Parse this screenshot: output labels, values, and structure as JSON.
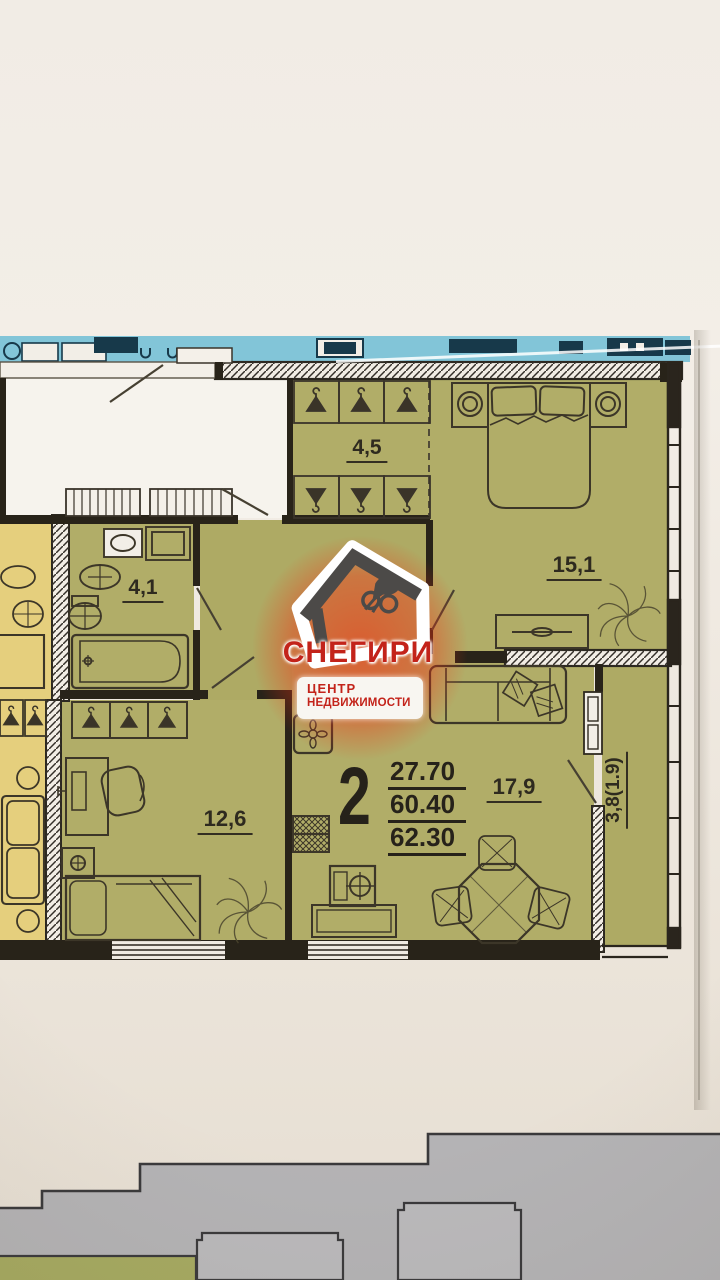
{
  "watermark": {
    "brand": "СНЕГИРИ",
    "tagline_line1": "ЦЕНТР",
    "tagline_line2": "НЕДВИЖИМОСТИ",
    "accent_color": "#c3231a"
  },
  "apartment": {
    "rooms_count": "2",
    "areas": {
      "living": "27.70",
      "apartment": "60.40",
      "total": "62.30"
    },
    "rooms": {
      "wardrobe": "4,5",
      "bedroom": "15,1",
      "bathroom": "4,1",
      "room": "12,6",
      "kitchen_living": "17,9",
      "balcony": "3,8(1.9)"
    }
  },
  "colors": {
    "floor_olive": "#b1ad68",
    "neighbor_yellow": "#e5cf7d",
    "upper_plan_blue": "#82c5d8",
    "elevation_gray": "#b4b3b5"
  }
}
